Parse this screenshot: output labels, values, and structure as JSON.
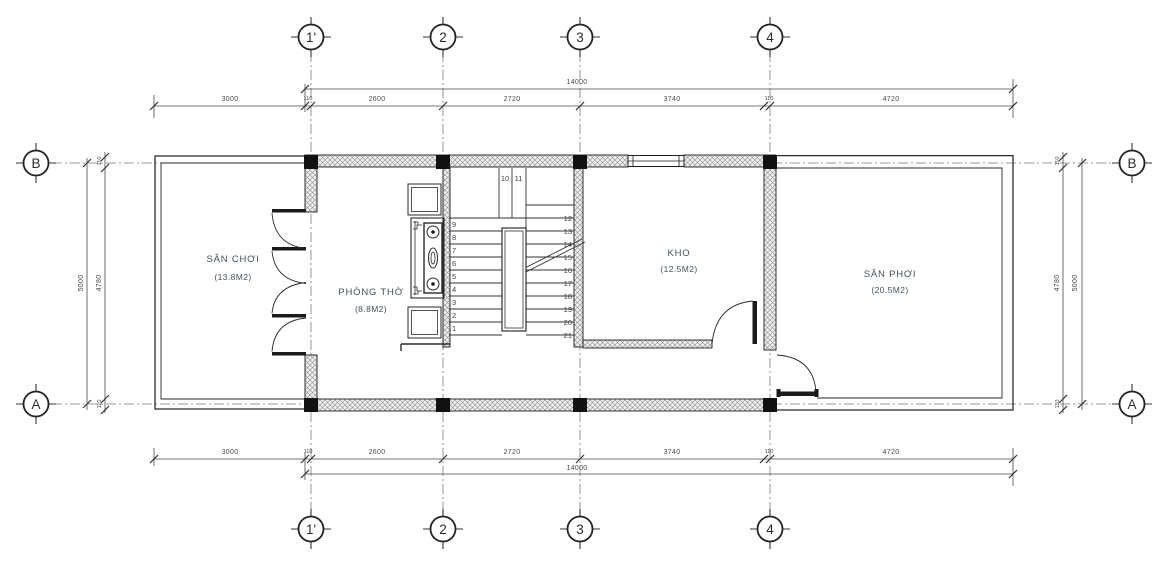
{
  "title": "Floor plan drawing",
  "axes": {
    "top": [
      "1'",
      "2",
      "3",
      "4"
    ],
    "bottom": [
      "1'",
      "2",
      "3",
      "4"
    ],
    "left": [
      "B",
      "A"
    ],
    "right": [
      "B",
      "A"
    ]
  },
  "dims": {
    "top": {
      "total": "14000",
      "segments": [
        "3000",
        "110",
        "2600",
        "2720",
        "3740",
        "110",
        "4720"
      ]
    },
    "bottom": {
      "total": "14000",
      "segments": [
        "3000",
        "110",
        "2600",
        "2720",
        "3740",
        "110",
        "4720"
      ]
    },
    "left": {
      "outer": "5000",
      "inner": "4780",
      "top_offset": "110",
      "bottom_offset": "110"
    },
    "right": {
      "outer": "5000",
      "inner": "4780",
      "top_offset": "110",
      "bottom_offset": "110"
    }
  },
  "rooms": [
    {
      "name": "SÂN CHƠI",
      "area": "(13.8M2)"
    },
    {
      "name": "PHÒNG THỜ",
      "area": "(8.8M2)"
    },
    {
      "name": "KHO",
      "area": "(12.5M2)"
    },
    {
      "name": "SÂN PHƠI",
      "area": "(20.5M2)"
    }
  ],
  "stairs": {
    "left": [
      "9",
      "8",
      "7",
      "6",
      "5",
      "4",
      "3",
      "2",
      "1"
    ],
    "right": [
      "12",
      "13",
      "14",
      "15",
      "16",
      "17",
      "18",
      "19",
      "20",
      "21"
    ],
    "top": [
      "10",
      "11"
    ]
  },
  "colors": {
    "line": "#2a2a2a",
    "dim": "#4a4a4a",
    "label": "#44505a",
    "column": "#111111",
    "hatch": "#8c8c8c"
  }
}
